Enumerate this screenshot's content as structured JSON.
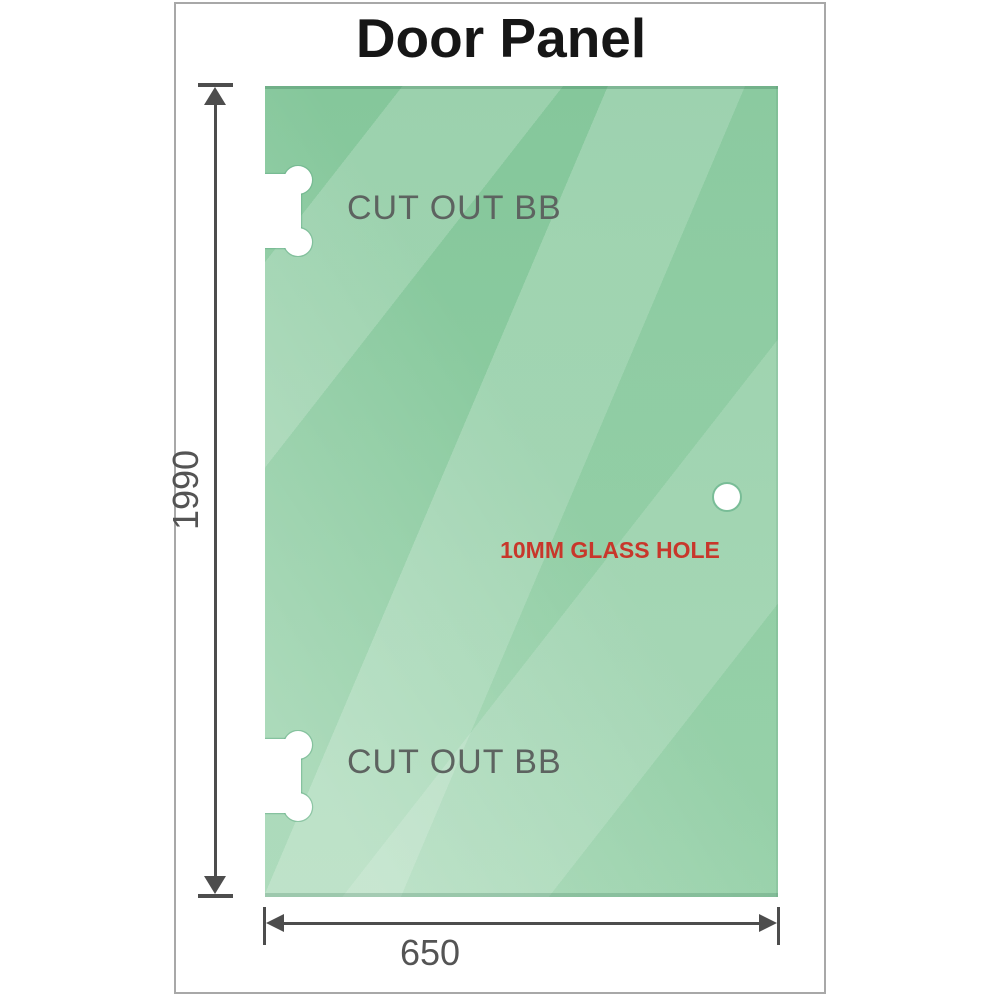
{
  "title": "Door Panel",
  "panel": {
    "cutouts": [
      {
        "label": "CUT OUT BB"
      },
      {
        "label": "CUT OUT BB"
      }
    ],
    "glass_hole": {
      "label": "10MM GLASS HOLE"
    }
  },
  "dimensions": {
    "height_mm": "1990",
    "width_mm": "650"
  },
  "colors": {
    "glass_green": "#8ccda2",
    "glass_highlight": "#b9e3c6",
    "glass_edge": "#79bd97",
    "cutout_white": "#ffffff",
    "dimension_gray": "#4d4d4d",
    "label_gray": "#5d6360",
    "hole_label_red": "#c8372b",
    "frame_border_gray": "#a8a8a8",
    "title_black": "#161616"
  }
}
